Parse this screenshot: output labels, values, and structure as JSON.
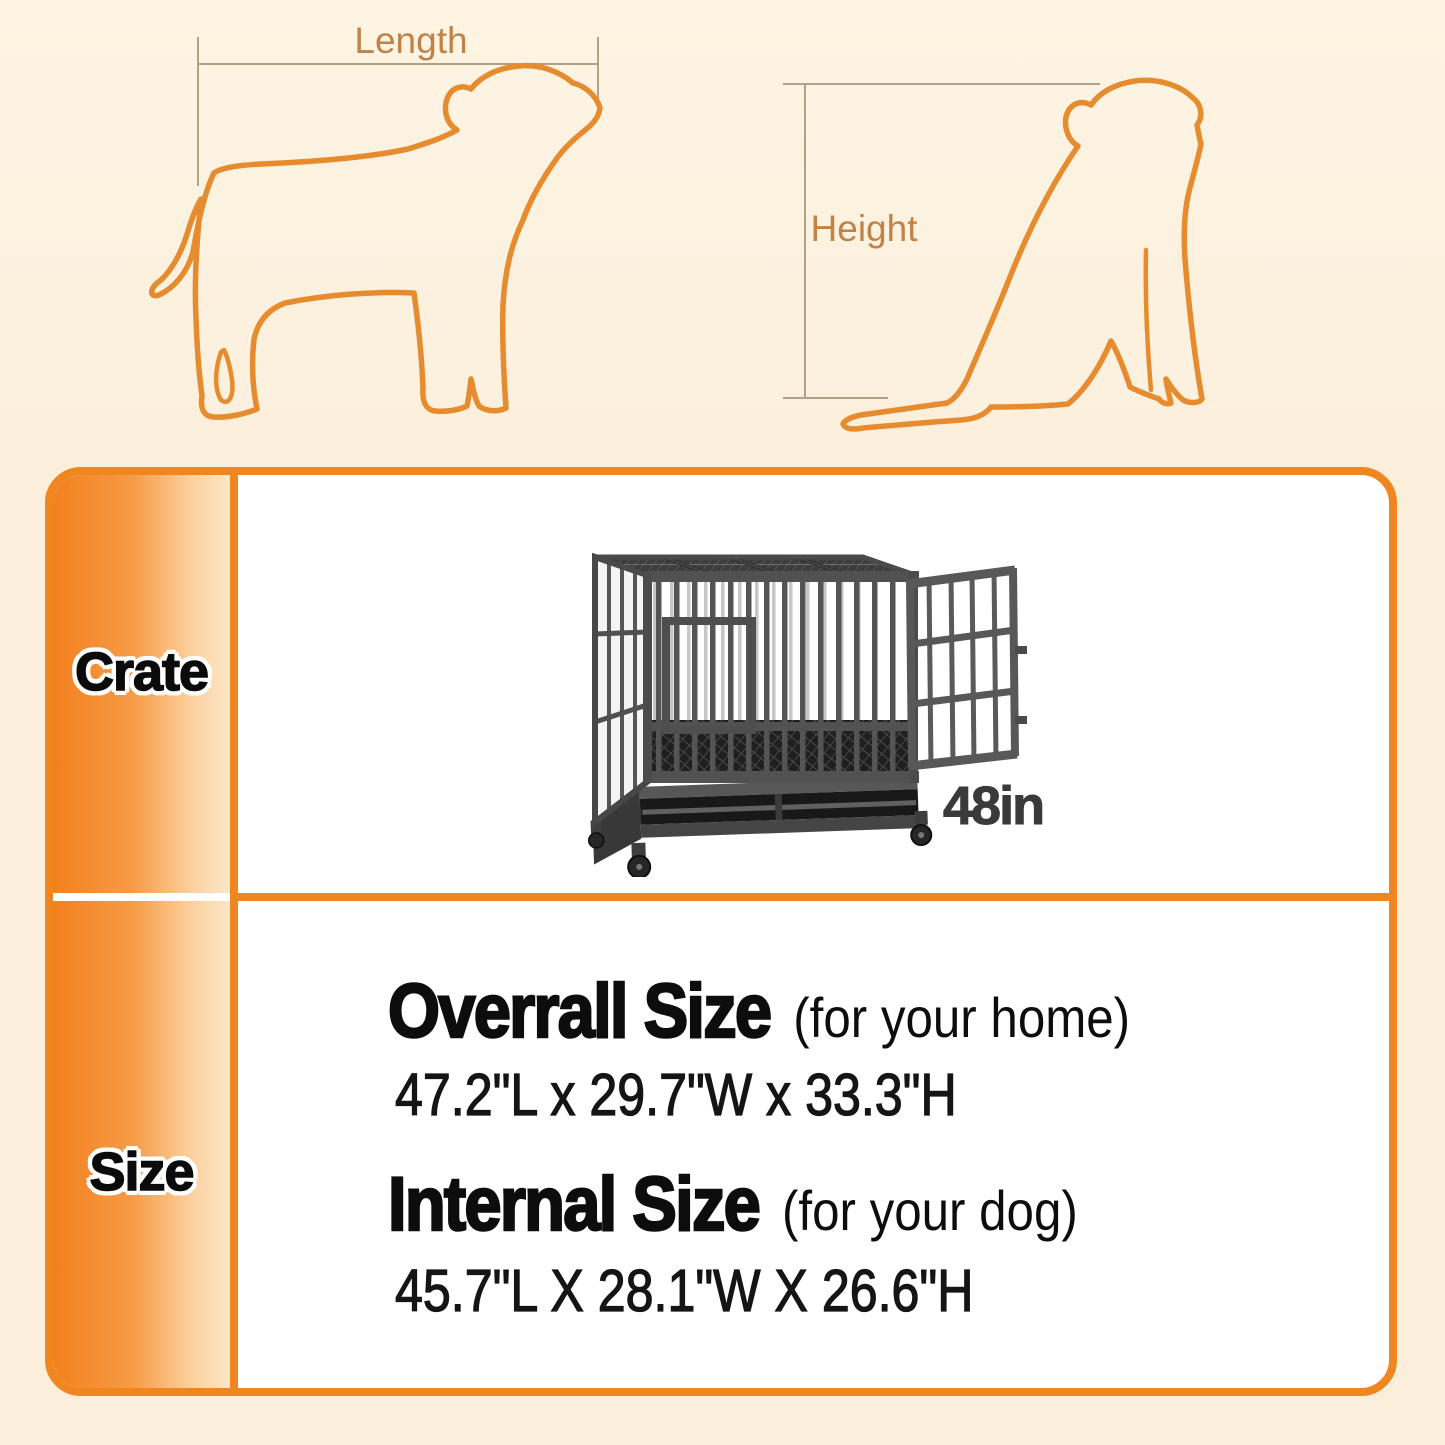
{
  "diagram": {
    "length_label": "Length",
    "height_label": "Height"
  },
  "panel": {
    "rows": [
      {
        "header": "Crate",
        "size_label": "48in"
      },
      {
        "header": "Size"
      }
    ],
    "overall": {
      "title": "Overrall Size",
      "note": "(for your home)",
      "dimensions": "47.2\"L x 29.7\"W x 33.3\"H"
    },
    "internal": {
      "title": "Internal Size",
      "note": "(for your dog)",
      "dimensions": "45.7\"L X 28.1\"W X 26.6\"H"
    }
  },
  "colors": {
    "accent_orange": "#ef861f",
    "dog_outline_orange": "#e68c2e",
    "measure_label_brown": "#c08347",
    "background_cream": "#fbeedb",
    "text_black": "#0d0d0d",
    "crate_gray": "#4f4f4f"
  }
}
